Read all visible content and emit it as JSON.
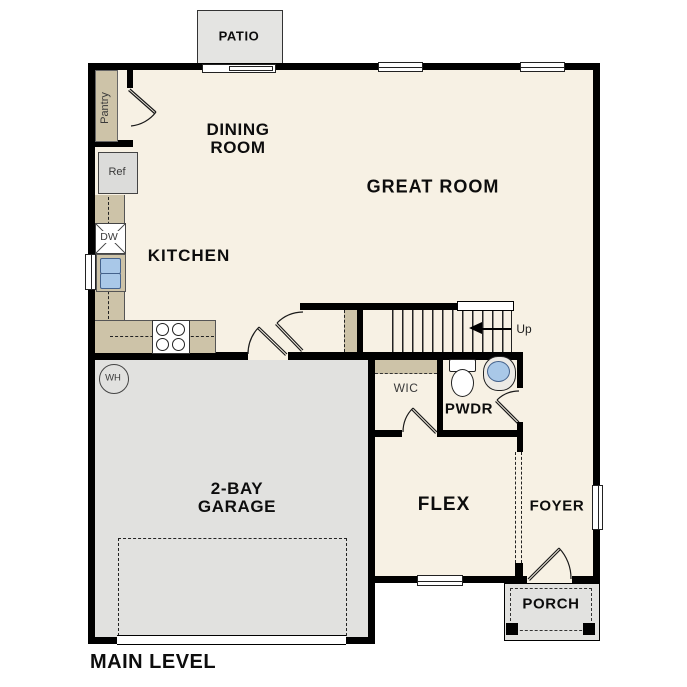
{
  "plan": {
    "title": "MAIN LEVEL",
    "rooms": {
      "patio": "PATIO",
      "dining_line1": "DINING",
      "dining_line2": "ROOM",
      "great_room": "GREAT ROOM",
      "kitchen": "KITCHEN",
      "garage_line1": "2-BAY",
      "garage_line2": "GARAGE",
      "wic": "WIC",
      "powder": "PWDR",
      "flex": "FLEX",
      "foyer": "FOYER",
      "porch": "PORCH"
    },
    "labels": {
      "pantry": "Pantry",
      "refrigerator": "Ref",
      "dishwasher": "DW",
      "water_heater": "WH",
      "stairs_direction": "Up"
    },
    "colors": {
      "floor_beige": "#f7f1e4",
      "counter_tan": "#cdc3a8",
      "garage_gray": "#e1e1df",
      "outdoor_gray": "#e4e4e2",
      "appliance_gray": "#dcdcda",
      "sink_blue": "#a9c8e8",
      "wall_black": "#000000"
    }
  }
}
